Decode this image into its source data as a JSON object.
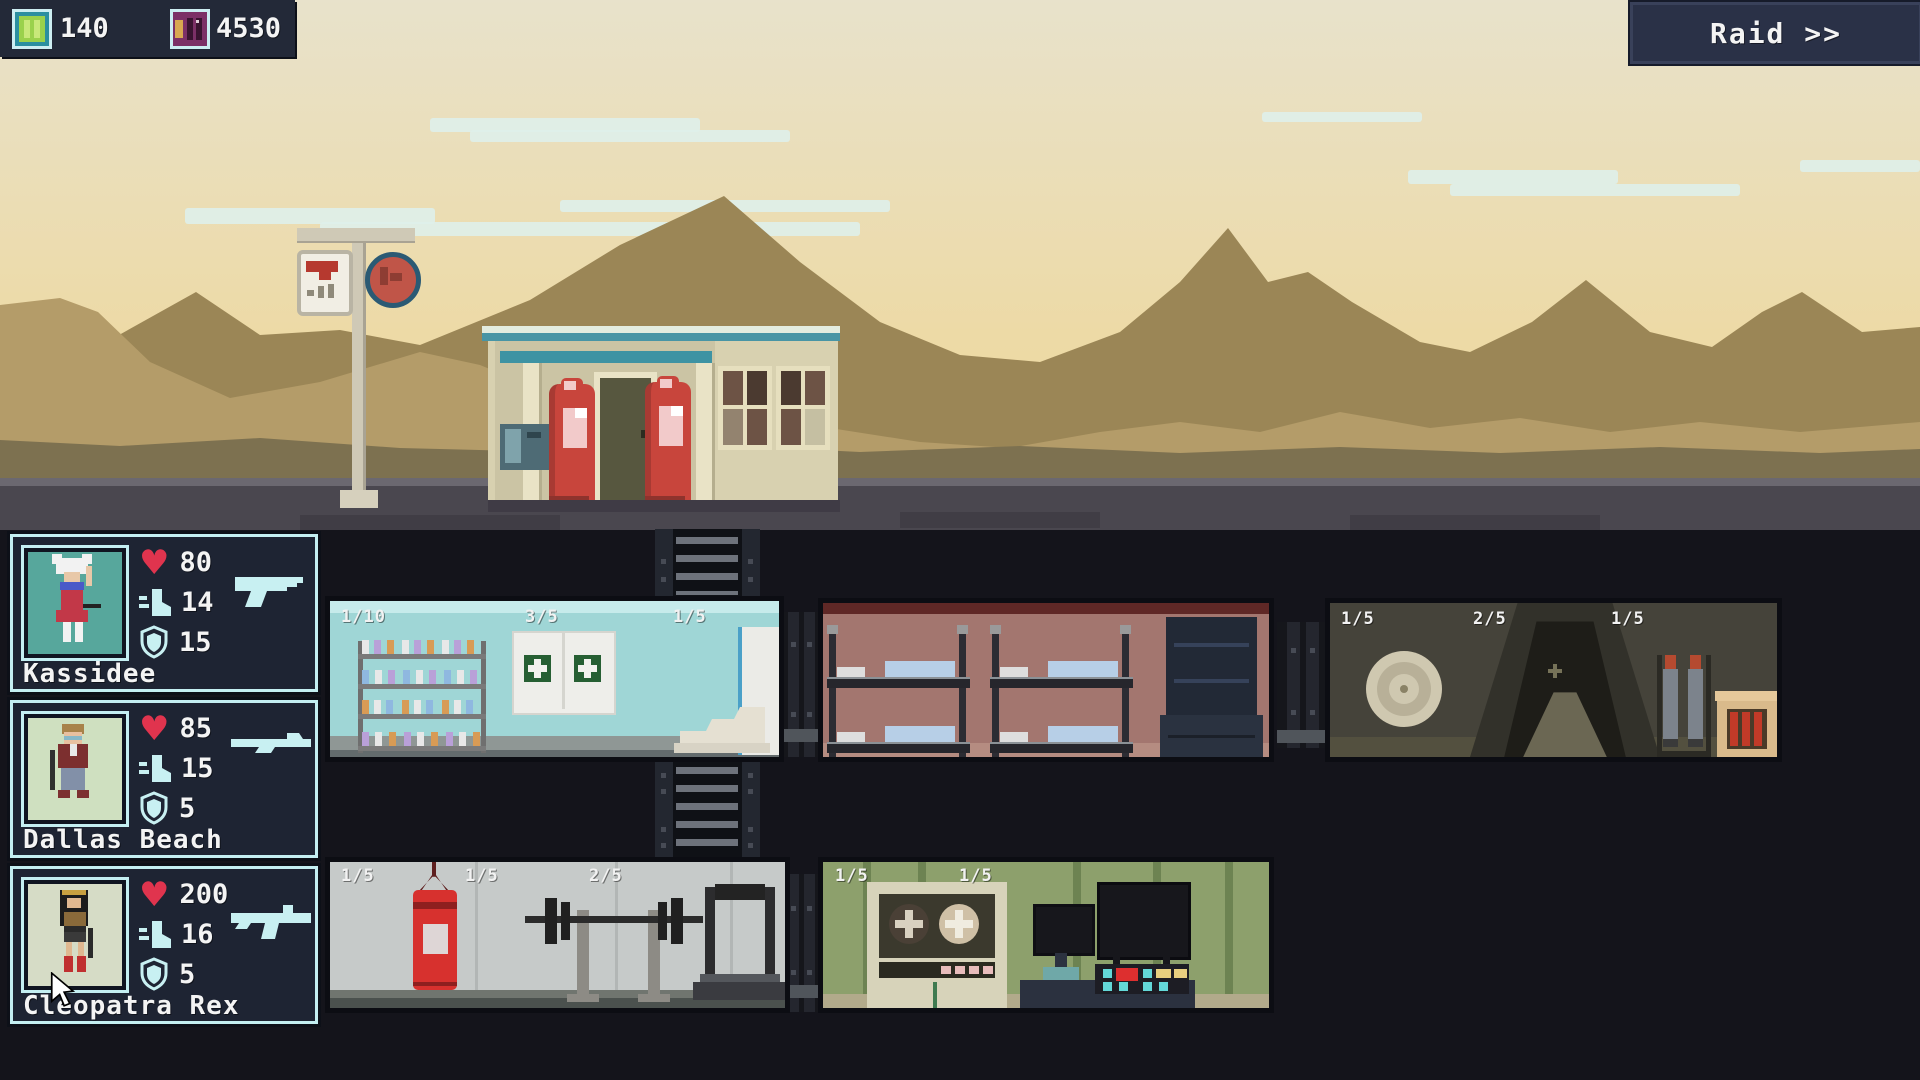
{
  "hud": {
    "resources": [
      {
        "icon": "battery-icon",
        "value": "140"
      },
      {
        "icon": "ammo-chip-icon",
        "value": "4530"
      }
    ],
    "raid_label": "Raid >>"
  },
  "scene": {
    "location": "abandoned-gas-station",
    "signs": [
      "price-sign",
      "round-sign"
    ]
  },
  "characters": [
    {
      "name": "Kassidee",
      "health": "80",
      "speed": "14",
      "armor": "15",
      "weapon": "pistol-icon"
    },
    {
      "name": "Dallas Beach",
      "health": "85",
      "speed": "15",
      "armor": "5",
      "weapon": "rifle-icon"
    },
    {
      "name": "Cleopatra Rex",
      "health": "200",
      "speed": "16",
      "armor": "5",
      "weapon": "smg-icon"
    }
  ],
  "rooms": {
    "medbay": {
      "labels": [
        "1/10",
        "3/5",
        "1/5"
      ]
    },
    "dorm": {
      "labels": []
    },
    "vault": {
      "labels": [
        "1/5",
        "2/5",
        "1/5"
      ]
    },
    "gym": {
      "labels": [
        "1/5",
        "1/5",
        "2/5"
      ]
    },
    "control": {
      "labels": [
        "1/5",
        "1/5"
      ]
    }
  },
  "colors": {
    "accent_cyan": "#c8f0f2",
    "heart_red": "#e0344e",
    "hud_navy": "#232938",
    "sky_top": "#e8e2cb",
    "sky_bottom": "#eed9a0"
  }
}
